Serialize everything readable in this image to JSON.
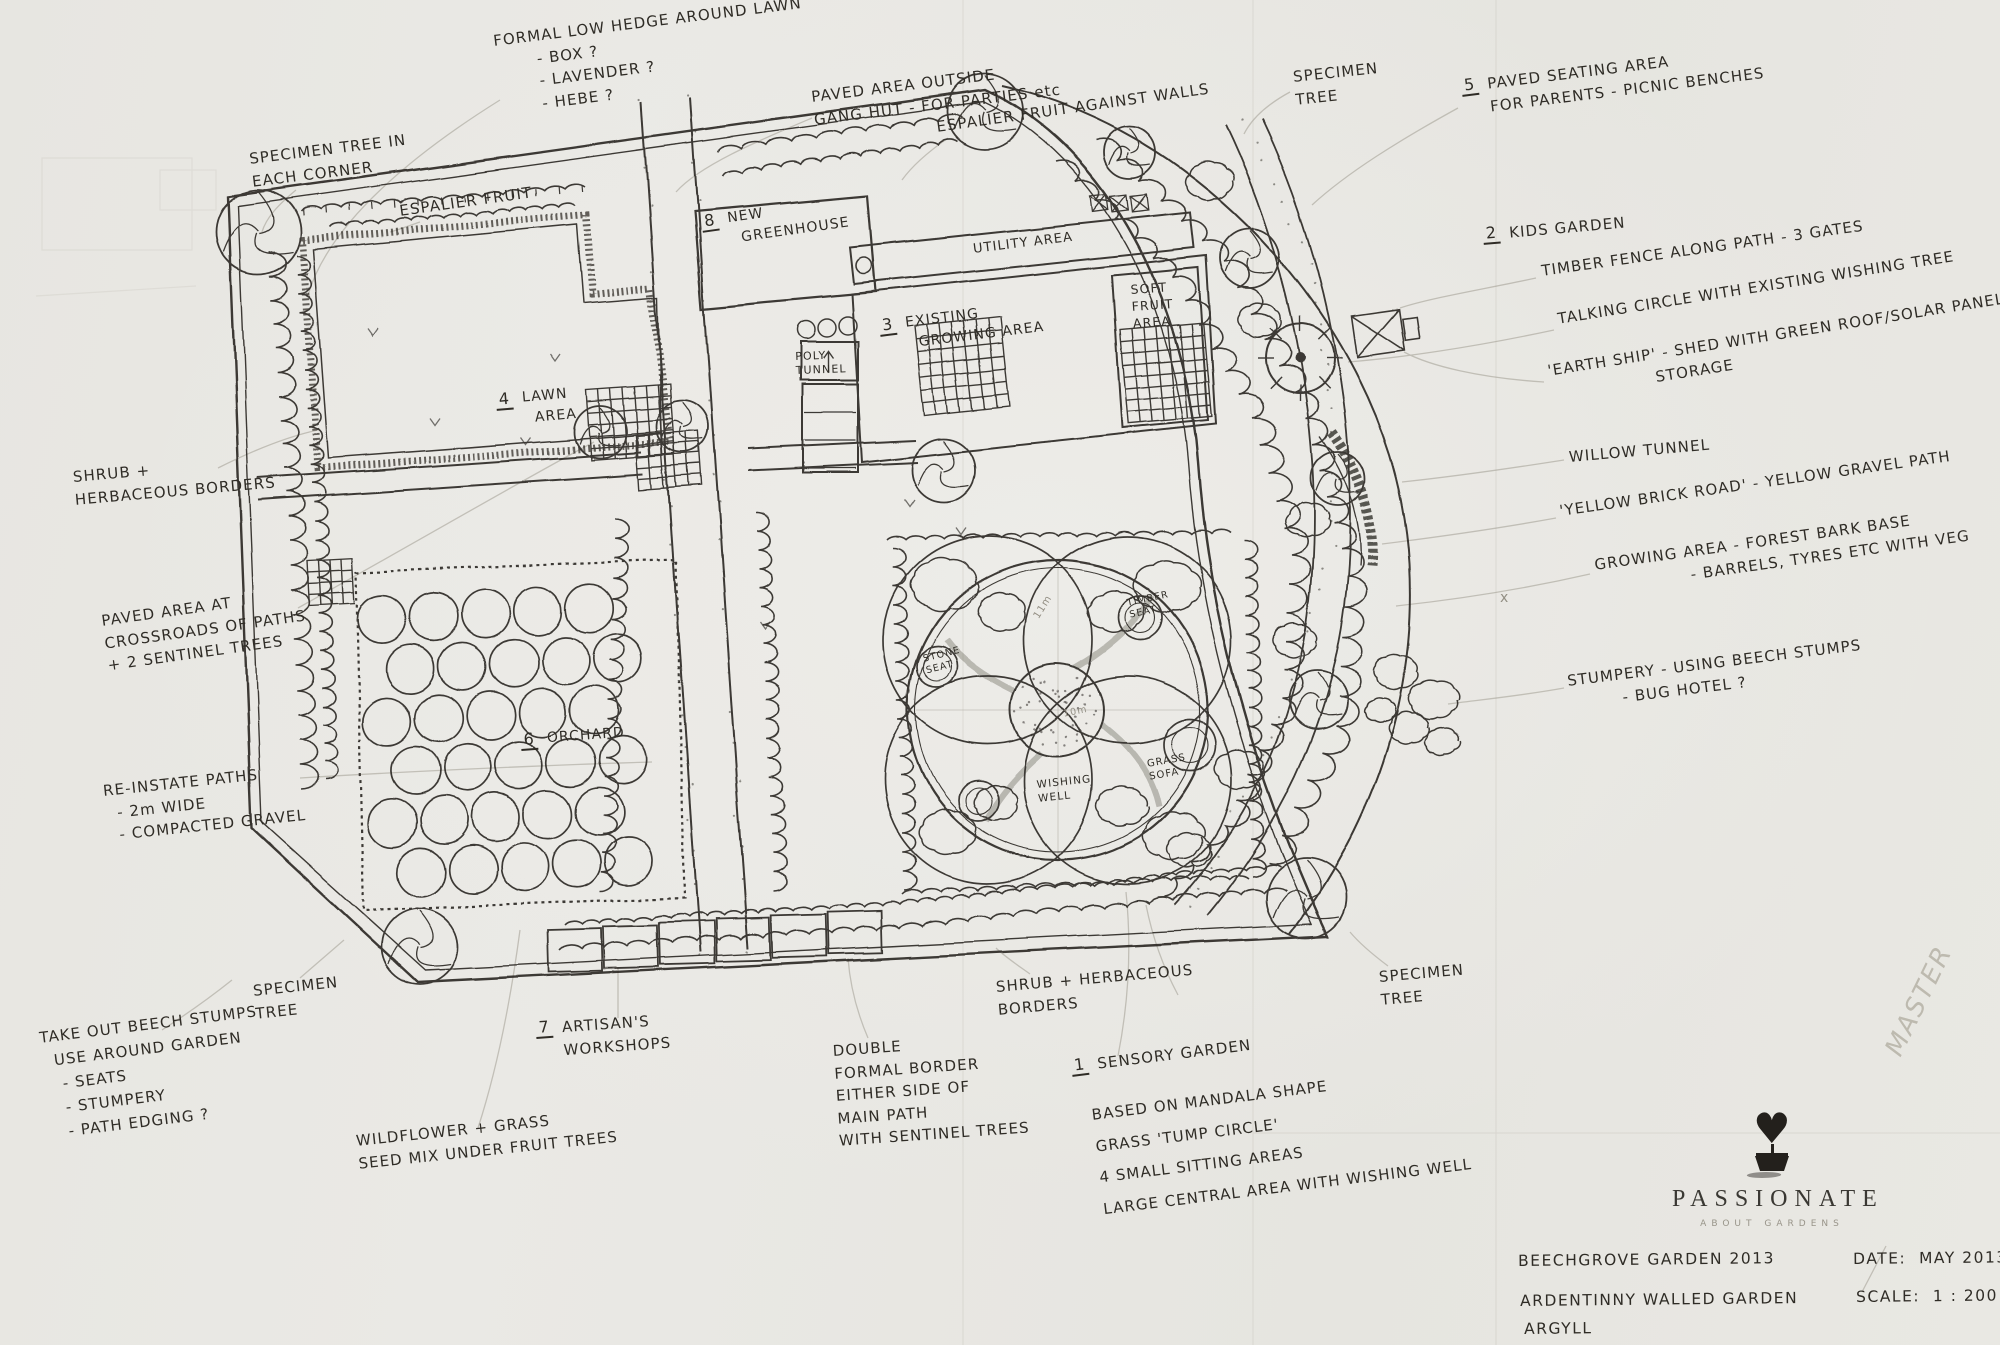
{
  "colors": {
    "paper": "#e8e7e2",
    "ink": "#2b2823",
    "pencil": "#a09c91"
  },
  "annotations": {
    "formal_hedge": {
      "text": "FORMAL LOW HEDGE AROUND LAWN\n       - BOX ?\n       - LAVENDER ?\n       - HEBE ?"
    },
    "specimen_corner": {
      "text": "SPECIMEN TREE IN\nEACH CORNER"
    },
    "espalier": {
      "text": "ESPALIER FRUIT"
    },
    "paved_gang_hut": {
      "text": "PAVED AREA OUTSIDE\nGANG HUT - FOR PARTIES etc"
    },
    "espalier_walls": {
      "text": "ESPALIER FRUIT AGAINST WALLS"
    },
    "specimen_top": {
      "text": "SPECIMEN\nTREE"
    },
    "paved_seating": {
      "num": "5",
      "text": "PAVED SEATING AREA\nFOR PARENTS - PICNIC BENCHES"
    },
    "kids_garden": {
      "num": "2",
      "text": "KIDS GARDEN"
    },
    "timber_fence": {
      "text": "TIMBER FENCE ALONG PATH - 3 GATES"
    },
    "talking_circle": {
      "text": "TALKING CIRCLE WITH EXISTING WISHING TREE"
    },
    "earth_ship": {
      "text": "'EARTH SHIP' - SHED WITH GREEN ROOF/SOLAR PANEL\n                  STORAGE"
    },
    "willow_tunnel": {
      "text": "WILLOW TUNNEL"
    },
    "yellow_brick_road": {
      "text": "'YELLOW BRICK ROAD' - YELLOW GRAVEL PATH"
    },
    "growing_area": {
      "text": "GROWING AREA - FOREST BARK BASE\n                - BARRELS, TYRES ETC WITH VEG"
    },
    "stumpery": {
      "text": "STUMPERY - USING BEECH STUMPS\n         - BUG HOTEL ?"
    },
    "shrub_left": {
      "text": "SHRUB +\nHERBACEOUS BORDERS"
    },
    "paved_crossroads": {
      "text": "PAVED AREA AT\nCROSSROADS OF PATHS\n+ 2 SENTINEL TREES"
    },
    "reinstate_paths": {
      "text": "RE-INSTATE PATHS\n  - 2m WIDE\n  - COMPACTED GRAVEL"
    },
    "beech_stumps": {
      "text": "TAKE OUT BEECH STUMPS\n  USE AROUND GARDEN\n   - SEATS\n   - STUMPERY\n   - PATH EDGING ?"
    },
    "specimen_bl": {
      "text": "SPECIMEN\nTREE"
    },
    "artisans": {
      "num": "7",
      "text": "ARTISAN'S\nWORKSHOPS"
    },
    "wildflower": {
      "text": "WILDFLOWER + GRASS\nSEED MIX UNDER FRUIT TREES"
    },
    "double_border": {
      "text": "DOUBLE\nFORMAL BORDER\nEITHER SIDE OF\nMAIN PATH\nWITH SENTINEL TREES"
    },
    "shrub_bottom": {
      "text": "SHRUB + HERBACEOUS\nBORDERS"
    },
    "sensory": {
      "num": "1",
      "text": "SENSORY GARDEN"
    },
    "sensory_notes": {
      "text": "BASED ON MANDALA SHAPE\nGRASS 'TUMP CIRCLE'\n4 SMALL SITTING AREAS\nLARGE CENTRAL AREA WITH WISHING WELL"
    },
    "specimen_br": {
      "text": "SPECIMEN\nTREE"
    }
  },
  "plan_labels": {
    "greenhouse": {
      "num": "8",
      "text": "NEW\n  GREENHOUSE"
    },
    "utility": {
      "text": "UTILITY AREA"
    },
    "growing": {
      "num": "3",
      "text": "EXISTING\n  GROWING AREA"
    },
    "soft_fruit": {
      "text": "SOFT\nFRUIT\nAREA"
    },
    "poly_tunnel": {
      "text": "POLY\nTUNNEL"
    },
    "lawn": {
      "num": "4",
      "text": "LAWN\n  AREA"
    },
    "orchard": {
      "num": "6",
      "text": "ORCHARD"
    },
    "timber_seat": {
      "text": "TIMBER\nSEAT"
    },
    "stone_seat": {
      "text": "STONE\nSEAT"
    },
    "wishing_well": {
      "text": "WISHING\nWELL"
    },
    "grass_sofa": {
      "text": "GRASS\nSOFA"
    },
    "dim_11m": {
      "text": "11m"
    },
    "dim_10m": {
      "text": "10m"
    },
    "x_mark": {
      "text": "x"
    }
  },
  "title_block": {
    "project": "BEECHGROVE GARDEN 2013",
    "site": "ARDENTINNY WALLED GARDEN",
    "region": "ARGYLL",
    "date": "DATE:  MAY 2013",
    "scale": "SCALE:  1 : 200"
  },
  "logo": {
    "name": "PASSIONATE",
    "subtitle": "ABOUT GARDENS",
    "heart_glyph": "♥",
    "icon": "heart-topiary-icon"
  },
  "watermark": "MASTER"
}
